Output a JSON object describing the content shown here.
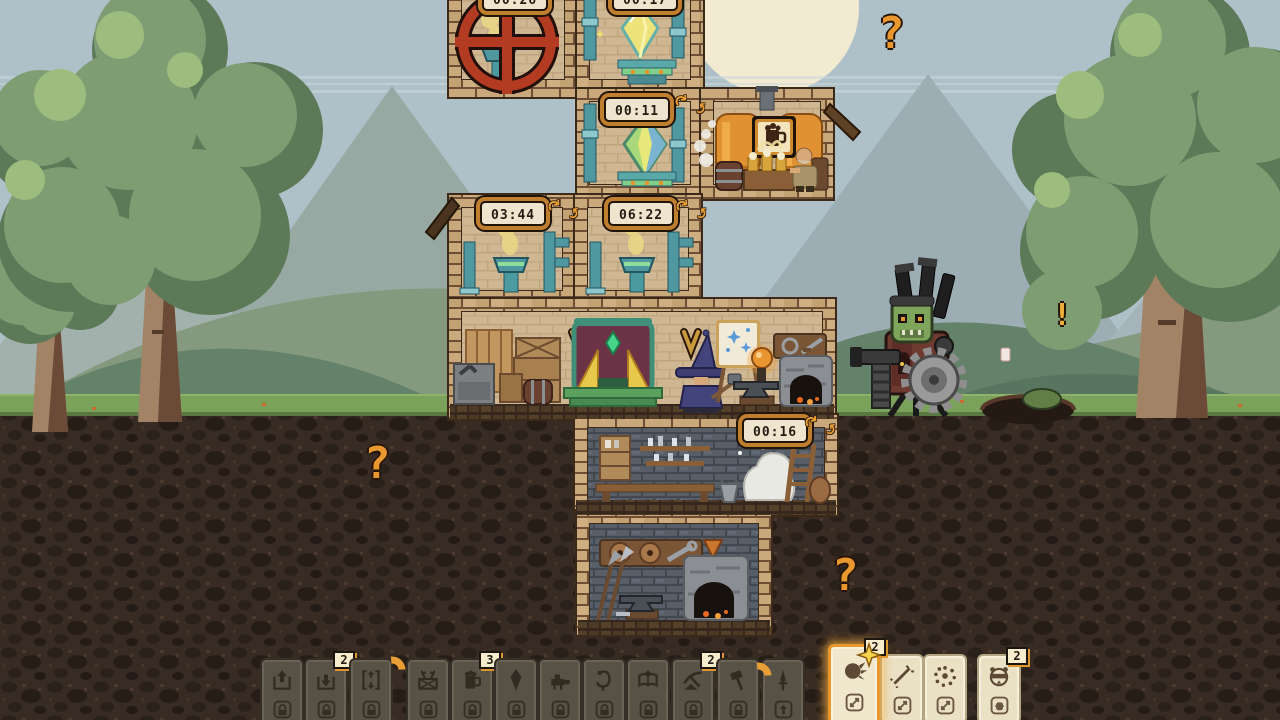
{
  "scene": {
    "timers": [
      {
        "id": "workshop-top-left",
        "value": "00:26",
        "clipped": true
      },
      {
        "id": "workshop-top-right",
        "value": "00:17",
        "clipped": true
      },
      {
        "id": "crystal-room",
        "value": "00:11"
      },
      {
        "id": "furnace-left",
        "value": "03:44"
      },
      {
        "id": "furnace-right",
        "value": "06:22"
      },
      {
        "id": "cellar",
        "value": "00:16"
      }
    ],
    "indicators": {
      "sky_question": "?",
      "underground_left_question": "?",
      "underground_right_question": "?",
      "enemy_alert": "!"
    },
    "entities": {
      "player": "wizard-at-anvil",
      "npc": "dwarf-drinking-in-brewery",
      "enemy": "goblin-skull-saw-turret",
      "blocked_room_sign": "red-crossed-wheel"
    }
  },
  "hotbar": {
    "cards": [
      {
        "icon": "room-send-up",
        "state": "locked",
        "badge": "",
        "sub": "lock"
      },
      {
        "icon": "room-receive-down",
        "state": "locked",
        "badge": "2",
        "sub": "lock"
      },
      {
        "icon": "room-elevator",
        "state": "locked",
        "badge": "",
        "sub": "lock"
      },
      {
        "icon": "weapon-crate",
        "state": "locked",
        "badge": "",
        "sub": "lock"
      },
      {
        "icon": "tavern-beer",
        "state": "locked",
        "badge": "3",
        "sub": "lock"
      },
      {
        "icon": "mana-crystal",
        "state": "locked",
        "badge": "",
        "sub": "lock"
      },
      {
        "icon": "war-machine",
        "state": "locked",
        "badge": "",
        "sub": "lock"
      },
      {
        "icon": "healer-staff",
        "state": "locked",
        "badge": "",
        "sub": "lock"
      },
      {
        "icon": "spellbook",
        "state": "locked",
        "badge": "",
        "sub": "lock"
      },
      {
        "icon": "mining-pick",
        "state": "locked",
        "badge": "2",
        "sub": "lock"
      },
      {
        "icon": "build-hammer",
        "state": "locked",
        "badge": "",
        "sub": "lock"
      },
      {
        "icon": "dagger",
        "state": "locked",
        "badge": "",
        "sub": "arrow-up"
      },
      {
        "icon": "mole-claw",
        "state": "selected",
        "badge": "2",
        "sub": "swap"
      },
      {
        "icon": "spark-slash",
        "state": "available",
        "badge": "",
        "sub": "swap"
      },
      {
        "icon": "burst",
        "state": "available",
        "badge": "",
        "sub": "swap"
      },
      {
        "icon": "mole-unit",
        "state": "available",
        "badge": "2",
        "sub": "barrel"
      }
    ]
  },
  "colors": {
    "accent_orange": "#e8992e",
    "timer_face": "#efe5cf",
    "sky": "#aec1c9",
    "moon": "#f3ead2",
    "grass": "#7ba25a",
    "dirt": "#382b23",
    "brick": "#c9a87b",
    "stone_wall": "#575d66",
    "pipe_teal": "#4f98a0",
    "danger_red": "#b23b22"
  }
}
